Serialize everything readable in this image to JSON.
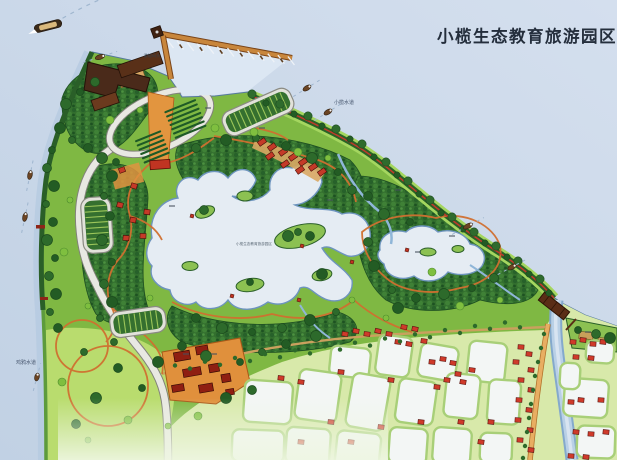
{
  "title": "小榄生态教育旅游园区",
  "labels": {
    "xiaolan_waterway": "小榄水道",
    "west_waterway": "鸡鸦水道",
    "marina": "游船码头",
    "lake_area": "小榄生态教育旅游园区"
  },
  "colors": {
    "river_water": "#ccd8e8",
    "lake_water": "#e5ecf3",
    "park_green": "#7fb843",
    "forest_green": "#2d6a2b",
    "meadow_green": "#b9dc6e",
    "path_orange": "#d07030",
    "road_grey": "#e8e8e2",
    "roof_red": "#cf3a2a",
    "building_brown": "#4a2a1a",
    "pier_tan": "#c8863c",
    "title_text": "#242e3c"
  }
}
